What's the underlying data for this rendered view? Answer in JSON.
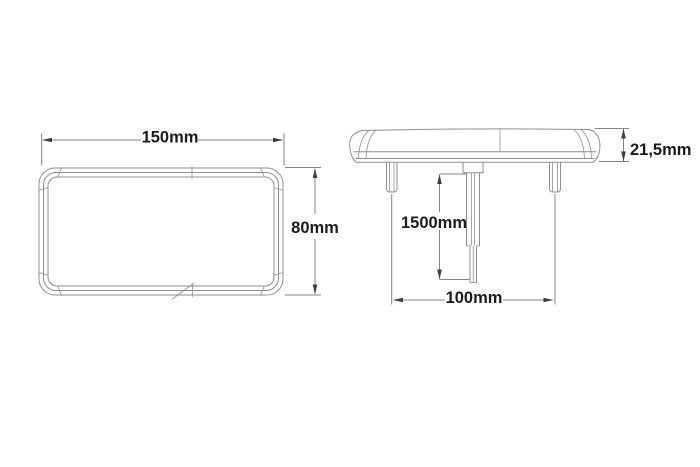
{
  "drawing": {
    "colors": {
      "background": "#ffffff",
      "line": "#8f8f8f",
      "dim_line": "#858585",
      "arrow": "#3f3f3f",
      "text": "#1b1b1b"
    },
    "views": {
      "front": "front-view",
      "side": "side-view"
    },
    "dimensions": {
      "width": "150mm",
      "height": "80mm",
      "thickness": "21,5mm",
      "cable_length": "1500mm",
      "stud_spacing": "100mm"
    }
  }
}
